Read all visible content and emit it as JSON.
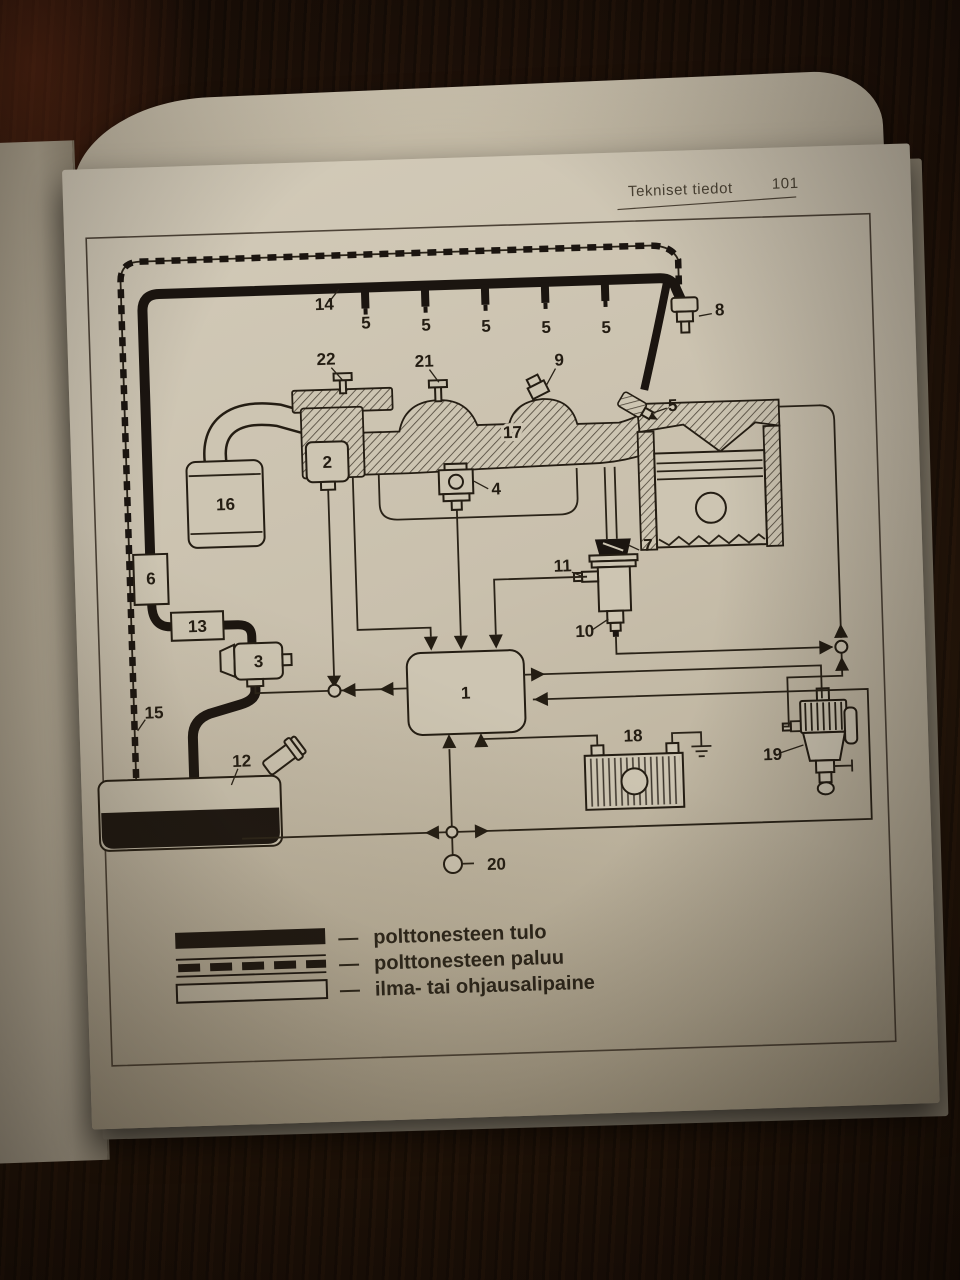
{
  "page": {
    "header_title": "Tekniset tiedot",
    "header_page_number": "101",
    "edge_fragment": "n"
  },
  "diagram": {
    "labels": {
      "n1": "1",
      "n2": "2",
      "n3": "3",
      "n4": "4",
      "n5": "5",
      "n6": "6",
      "n7": "7",
      "n8": "8",
      "n9": "9",
      "n10": "10",
      "n11": "11",
      "n12": "12",
      "n13": "13",
      "n14": "14",
      "n15": "15",
      "n16": "16",
      "n17": "17",
      "n18": "18",
      "n19": "19",
      "n20": "20",
      "n21": "21",
      "n22": "22"
    }
  },
  "legend": {
    "items": [
      {
        "dash": "—",
        "label": "polttonesteen tulo"
      },
      {
        "dash": "—",
        "label": "polttonesteen paluu"
      },
      {
        "dash": "—",
        "label": "ilma- tai ohjausalipaine"
      }
    ]
  },
  "colors": {
    "paper": "#c9c0ad",
    "ink": "#241d13",
    "wood": "#21130a"
  }
}
